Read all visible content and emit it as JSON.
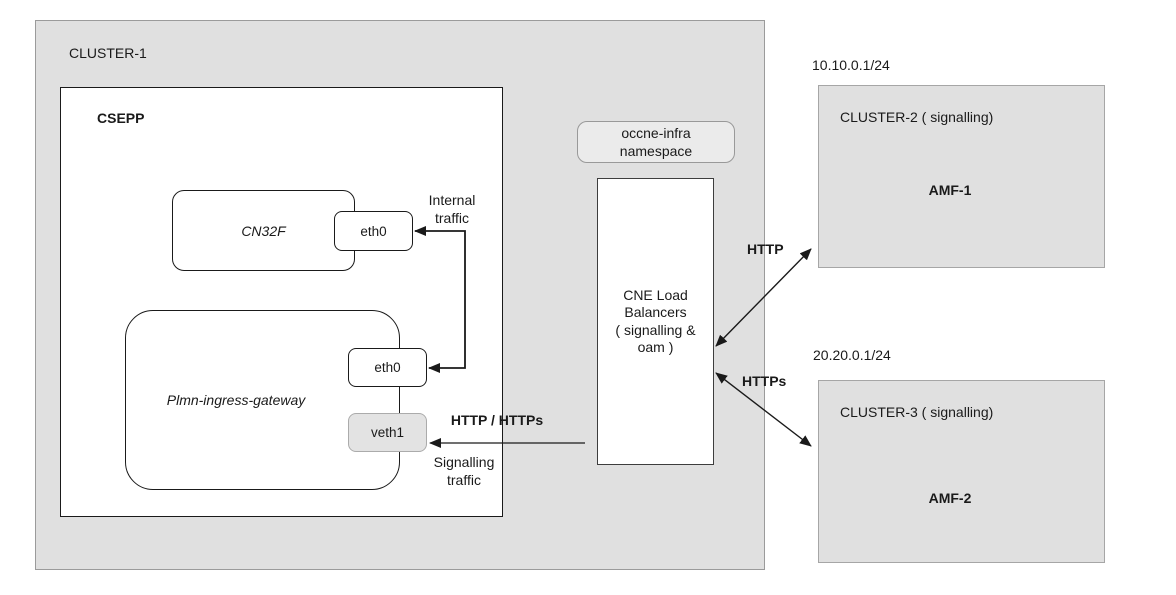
{
  "palette": {
    "page_background": "#ffffff",
    "cluster_fill": "#e0e0e0",
    "cluster_border": "#9b9b9b",
    "node_fill": "#ffffff",
    "node_border": "#1a1a1a",
    "veth_fill": "#e3e3e3",
    "veth_border": "#ababab",
    "arrow_color": "#1a1a1a"
  },
  "cluster1": {
    "label": "CLUSTER-1",
    "csepp": {
      "label": "CSEPP",
      "cn32f": {
        "label": "CN32F",
        "interface_eth0": "eth0"
      },
      "gateway": {
        "label": "Plmn-ingress-gateway",
        "interface_eth0": "eth0",
        "interface_veth1": "veth1"
      }
    }
  },
  "infra": {
    "namespace_badge": "occne-infra\nnamespace",
    "load_balancer": "CNE Load\nBalancers\n( signalling &\noam )"
  },
  "flows": {
    "internal": "Internal\ntraffic",
    "signalling_protocols": "HTTP / HTTPs",
    "signalling": "Signalling\ntraffic",
    "http": "HTTP",
    "https": "HTTPs"
  },
  "cluster2": {
    "subnet": "10.10.0.1/24",
    "label": "CLUSTER-2 ( signalling)",
    "node": "AMF-1"
  },
  "cluster3": {
    "subnet": "20.20.0.1/24",
    "label": "CLUSTER-3 ( signalling)",
    "node": "AMF-2"
  }
}
